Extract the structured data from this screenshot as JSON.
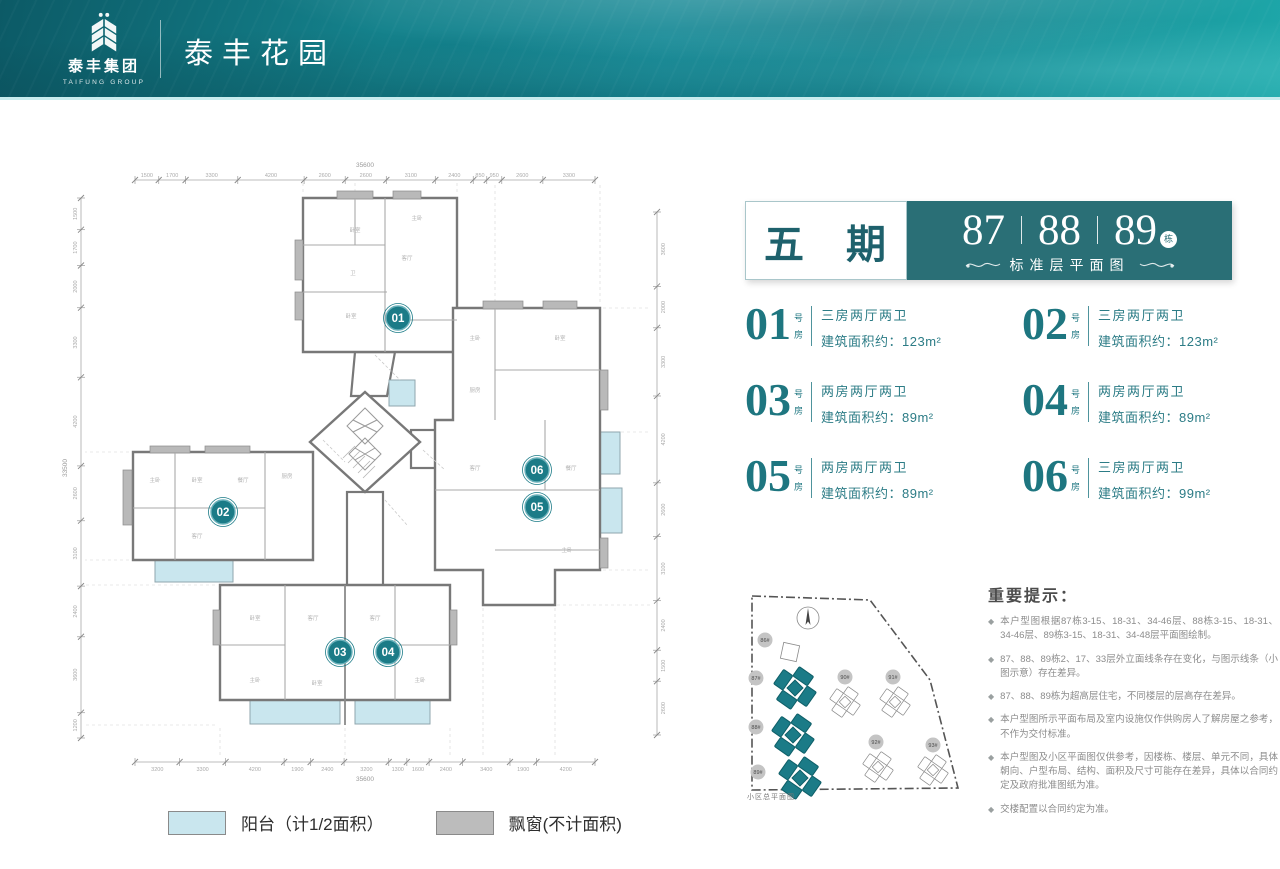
{
  "header": {
    "logo": {
      "icon": "wheat-leaf-logo",
      "company": "泰丰集团",
      "company_en": "TAIFUNG GROUP"
    },
    "project_name": "泰丰花园"
  },
  "title_block": {
    "phase": "五 期",
    "buildings": [
      "87",
      "88",
      "89"
    ],
    "unit_suffix": "栋",
    "subtitle": "标准层平面图"
  },
  "units_meta": {
    "suffix_top": "号",
    "suffix_bottom": "房"
  },
  "units": [
    {
      "no": "01",
      "layout": "三房两厅两卫",
      "area": "建筑面积约：123m²"
    },
    {
      "no": "02",
      "layout": "三房两厅两卫",
      "area": "建筑面积约：123m²"
    },
    {
      "no": "03",
      "layout": "两房两厅两卫",
      "area": "建筑面积约：89m²"
    },
    {
      "no": "04",
      "layout": "两房两厅两卫",
      "area": "建筑面积约：89m²"
    },
    {
      "no": "05",
      "layout": "两房两厅两卫",
      "area": "建筑面积约：89m²"
    },
    {
      "no": "06",
      "layout": "三房两厅两卫",
      "area": "建筑面积约：99m²"
    }
  ],
  "floor_plan": {
    "markers": [
      {
        "label": "01",
        "x": 343,
        "y": 178
      },
      {
        "label": "02",
        "x": 168,
        "y": 372
      },
      {
        "label": "03",
        "x": 285,
        "y": 512
      },
      {
        "label": "04",
        "x": 333,
        "y": 512
      },
      {
        "label": "05",
        "x": 482,
        "y": 367
      },
      {
        "label": "06",
        "x": 482,
        "y": 330
      }
    ],
    "room_labels": [
      {
        "x": 300,
        "y": 92,
        "t": "卧室"
      },
      {
        "x": 298,
        "y": 135,
        "t": "卫"
      },
      {
        "x": 296,
        "y": 178,
        "t": "卧室"
      },
      {
        "x": 362,
        "y": 80,
        "t": "主卧"
      },
      {
        "x": 352,
        "y": 120,
        "t": "客厅"
      },
      {
        "x": 100,
        "y": 342,
        "t": "主卧"
      },
      {
        "x": 142,
        "y": 342,
        "t": "卧室"
      },
      {
        "x": 188,
        "y": 342,
        "t": "餐厅"
      },
      {
        "x": 232,
        "y": 338,
        "t": "厨房"
      },
      {
        "x": 142,
        "y": 398,
        "t": "客厅"
      },
      {
        "x": 200,
        "y": 480,
        "t": "卧室"
      },
      {
        "x": 258,
        "y": 480,
        "t": "客厅"
      },
      {
        "x": 320,
        "y": 480,
        "t": "客厅"
      },
      {
        "x": 200,
        "y": 542,
        "t": "主卧"
      },
      {
        "x": 365,
        "y": 542,
        "t": "主卧"
      },
      {
        "x": 262,
        "y": 545,
        "t": "卧室"
      },
      {
        "x": 420,
        "y": 200,
        "t": "主卧"
      },
      {
        "x": 505,
        "y": 200,
        "t": "卧室"
      },
      {
        "x": 420,
        "y": 330,
        "t": "客厅"
      },
      {
        "x": 516,
        "y": 330,
        "t": "餐厅"
      },
      {
        "x": 512,
        "y": 412,
        "t": "主卧"
      },
      {
        "x": 420,
        "y": 252,
        "t": "厨房"
      }
    ],
    "dims_top": [
      "1500",
      "1700",
      "3300",
      "4200",
      "2600",
      "2600",
      "3100",
      "2400",
      "850",
      "950",
      "2600",
      "3300"
    ],
    "dims_bottom": [
      "3200",
      "3300",
      "4200",
      "1900",
      "2400",
      "3200",
      "1300",
      "1600",
      "2400",
      "3400",
      "1900",
      "4200"
    ],
    "dims_left": [
      "1500",
      "1700",
      "2000",
      "3300",
      "4200",
      "2600",
      "3100",
      "2400",
      "3600",
      "1200"
    ],
    "dims_right": [
      "3600",
      "2000",
      "3300",
      "4200",
      "2600",
      "3100",
      "2400",
      "1500",
      "2600"
    ],
    "totals": {
      "top": "35600",
      "bottom": "35600",
      "left": "33500"
    }
  },
  "site_map": {
    "caption": "小区总平面图",
    "buildings": [
      {
        "label": "86#",
        "x": 47,
        "y": 70,
        "lx": 22,
        "ly": 58,
        "hl": false,
        "type": "square"
      },
      {
        "label": "87#",
        "x": 52,
        "y": 106,
        "lx": 13,
        "ly": 96,
        "hl": true,
        "type": "pin"
      },
      {
        "label": "88#",
        "x": 50,
        "y": 153,
        "lx": 13,
        "ly": 145,
        "hl": true,
        "type": "pin"
      },
      {
        "label": "89#",
        "x": 57,
        "y": 196,
        "lx": 15,
        "ly": 190,
        "hl": true,
        "type": "pin"
      },
      {
        "label": "90#",
        "x": 102,
        "y": 120,
        "lx": 102,
        "ly": 95,
        "hl": false,
        "type": "pin"
      },
      {
        "label": "91#",
        "x": 152,
        "y": 120,
        "lx": 150,
        "ly": 95,
        "hl": false,
        "type": "pin"
      },
      {
        "label": "92#",
        "x": 135,
        "y": 185,
        "lx": 133,
        "ly": 160,
        "hl": false,
        "type": "pin"
      },
      {
        "label": "93#",
        "x": 190,
        "y": 188,
        "lx": 190,
        "ly": 163,
        "hl": false,
        "type": "pin"
      }
    ]
  },
  "notes": {
    "title": "重要提示：",
    "bullet": "◆",
    "items": [
      "本户型图根据87栋3-15、18-31、34-46层、88栋3-15、18-31、34-46层、89栋3-15、18-31、34-48层平面图绘制。",
      "87、88、89栋2、17、33层外立面线条存在变化，与图示线条（小图示意）存在差异。",
      "87、88、89栋为超高层住宅，不同楼层的层高存在差异。",
      "本户型图所示平面布局及室内设施仅作供购房人了解房屋之参考，不作为交付标准。",
      "本户型图及小区平面图仅供参考，因楼栋、楼层、单元不同，具体朝向、户型布局、结构、面积及尺寸可能存在差异，具体以合同约定及政府批准图纸为准。",
      "交楼配置以合同约定为准。"
    ]
  },
  "legend": [
    {
      "color": "#c9e6ee",
      "label": "阳台（计1/2面积）"
    },
    {
      "color": "#bcbcbc",
      "label": "飘窗(不计面积)"
    }
  ],
  "colors": {
    "accent": "#1b7b87",
    "teal_dark": "#2a6f76",
    "balcony": "#c9e6ee",
    "wall": "#787878",
    "bay": "#b9b9b9"
  }
}
